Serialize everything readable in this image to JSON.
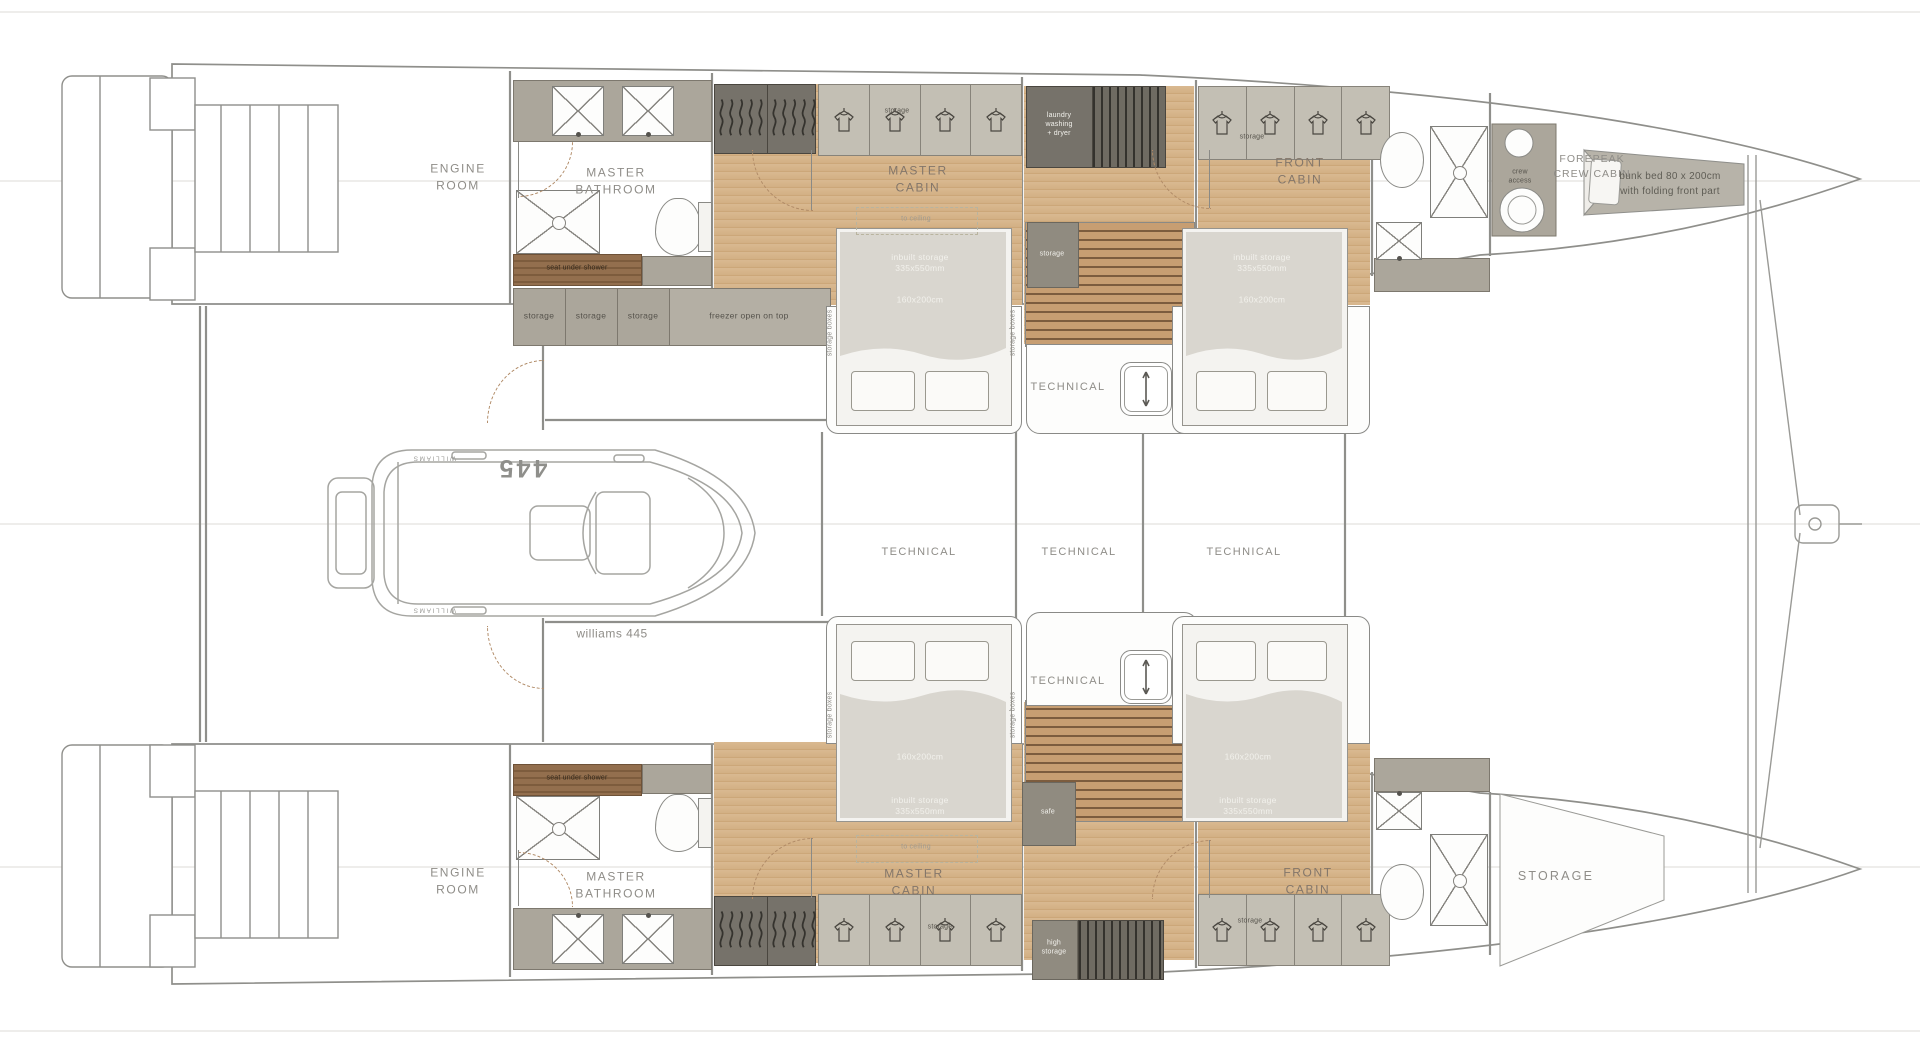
{
  "document": {
    "type": "yacht floor plan",
    "subject": "catamaran lower deck layout with tender"
  },
  "labels": {
    "engine_room": "ENGINE\nROOM",
    "master_bathroom": "MASTER\nBATHROOM",
    "master_cabin": "MASTER\nCABIN",
    "front_cabin": "FRONT\nCABIN",
    "forepeak_crew_cabin": "FOREPEAK\nCREW CABIN",
    "technical": "TECHNICAL",
    "storage_room": "STORAGE",
    "storage": "storage",
    "storage_boxes": "storage boxes",
    "freezer": "freezer open on top",
    "laundry": "laundry\nwashing\n+ dryer",
    "seat_under_shower": "seat under shower",
    "to_ceiling": "to ceiling",
    "inbuilt_storage": "inbuilt storage\n335x550mm",
    "bed_size": "160x200cm",
    "safe": "safe",
    "high_storage": "high\nstorage",
    "crew_access": "crew\naccess",
    "bunk_bed": "bunk bed 80 x 200cm\nwith folding front part",
    "tender_caption": "williams 445",
    "tender_model": "445",
    "tender_brand": "WILLIAMS"
  },
  "colors": {
    "wood": "#d6b58e",
    "furniture_taupe": "#aba69b",
    "dark_unit": "#6f6b62",
    "teak_strip": "#8a6a4c",
    "blanket": "#d9d6cf",
    "outline": "#8f8f8b"
  }
}
